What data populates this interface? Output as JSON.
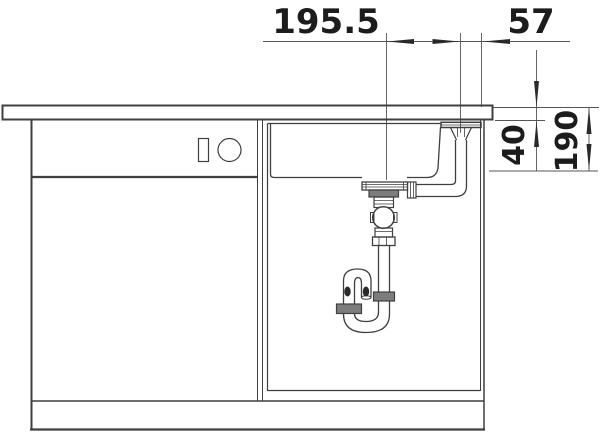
{
  "drawing": {
    "background_color": "#ffffff",
    "line_color": "#3f3f3f",
    "text_color": "#1c1c1c",
    "metal_shade": "#7d7d7d",
    "dimensions": {
      "drain_offset": "195.5",
      "overflow_offset": "57",
      "countertop_thickness": "40",
      "outlet_height": "190"
    }
  }
}
